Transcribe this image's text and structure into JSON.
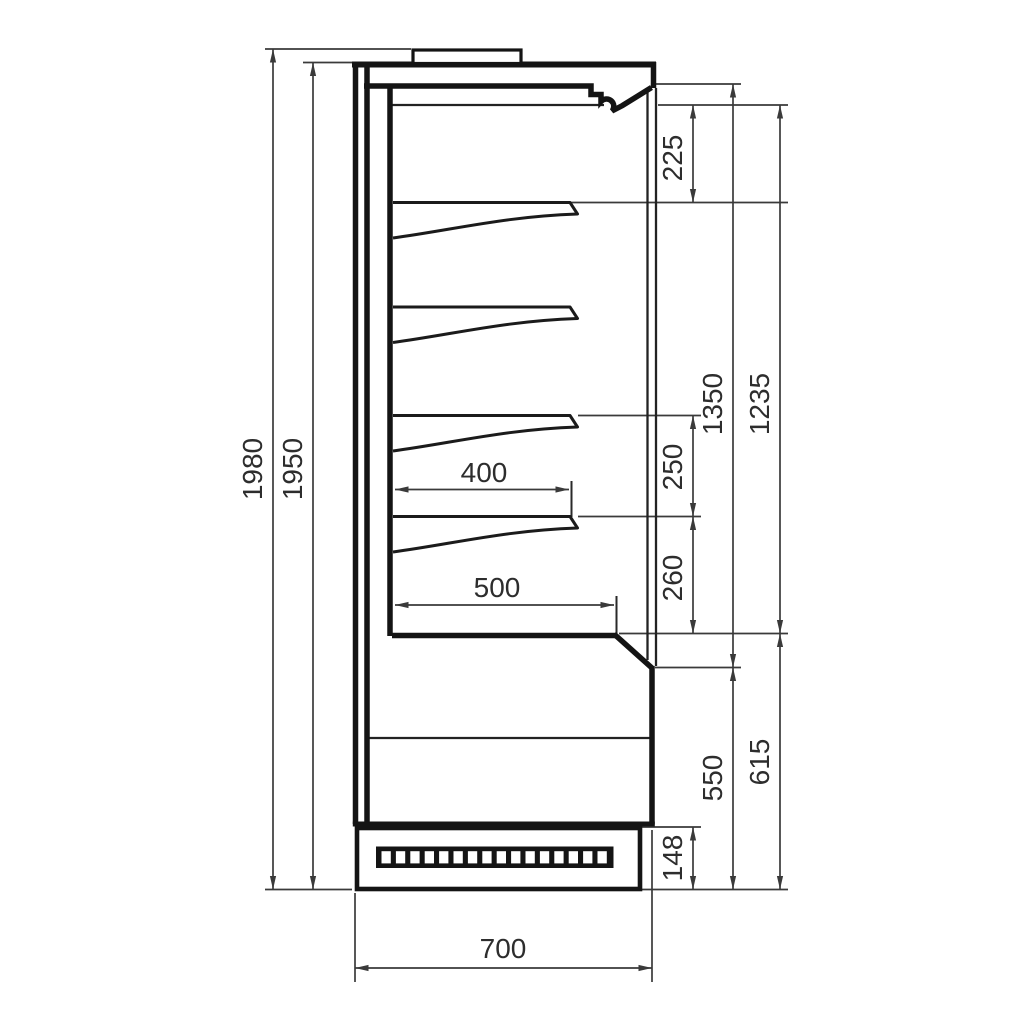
{
  "drawing": {
    "dimensions": {
      "overall_height": "1980",
      "body_height": "1950",
      "canopy_to_top_shelf": "225",
      "interior_height_front": "1350",
      "interior_height_inner": "1235",
      "shelf_spacing": "250",
      "shelf_to_deck": "260",
      "shelf_depth": "400",
      "deck_depth": "500",
      "lower_height_outer": "615",
      "lower_height_front": "550",
      "plinth_height": "148",
      "overall_depth": "700"
    },
    "colors": {
      "background": "#ffffff",
      "outline": "#141414",
      "dimension_lines": "#3a3a3a",
      "label_text": "#2d2d2d"
    }
  }
}
